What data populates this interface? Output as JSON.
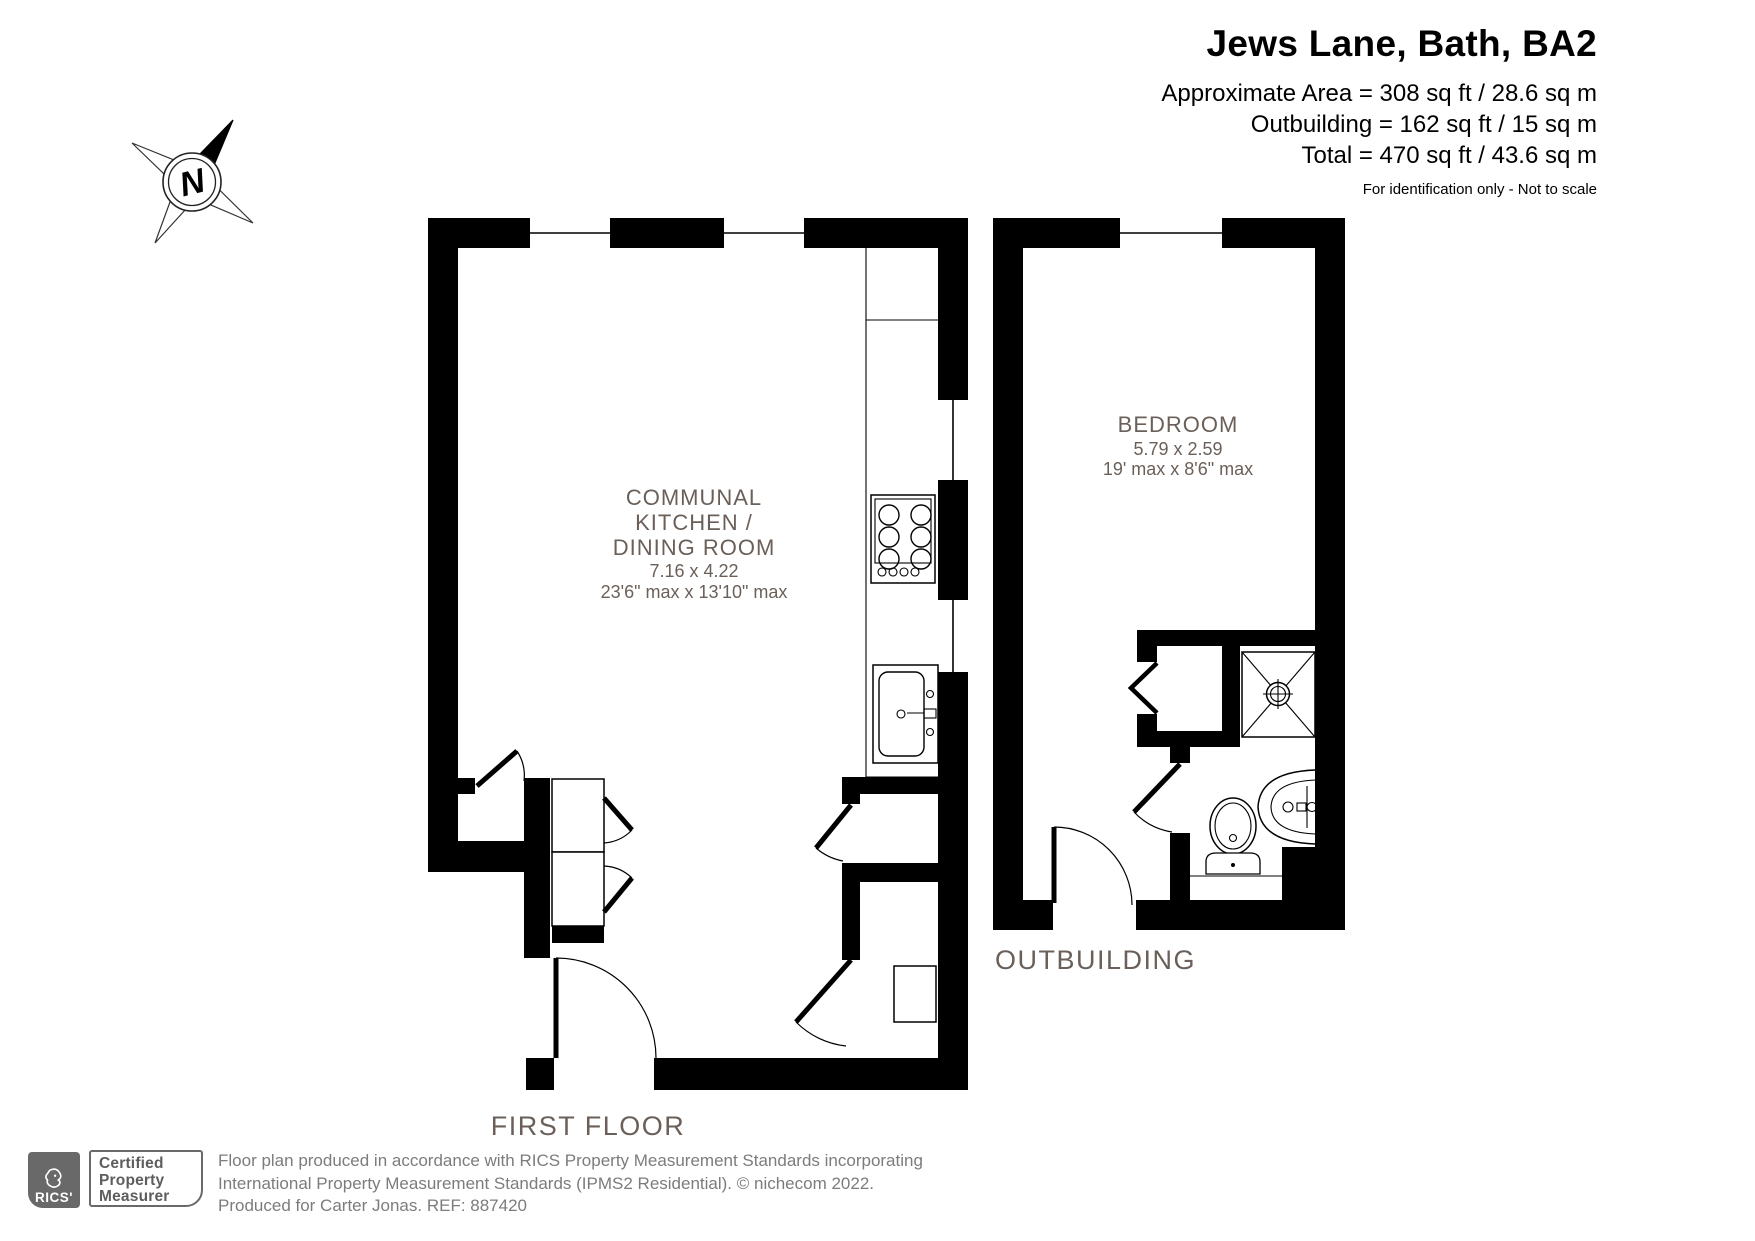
{
  "header": {
    "title": "Jews Lane, Bath, BA2",
    "area_line1": "Approximate Area = 308 sq ft / 28.6 sq m",
    "area_line2": "Outbuilding = 162 sq ft / 15 sq m",
    "area_line3": "Total = 470 sq ft / 43.6 sq m",
    "disclaimer": "For identification only - Not to scale"
  },
  "compass": {
    "north_label": "N"
  },
  "rooms": {
    "kitchen": {
      "line1": "COMMUNAL",
      "line2": "KITCHEN /",
      "line3": "DINING ROOM",
      "dims_metric": "7.16 x 4.22",
      "dims_imperial": "23'6\" max x 13'10\" max"
    },
    "bedroom": {
      "name": "BEDROOM",
      "dims_metric": "5.79 x 2.59",
      "dims_imperial": "19' max x 8'6\" max"
    }
  },
  "floor_labels": {
    "first_floor": "FIRST FLOOR",
    "outbuilding": "OUTBUILDING"
  },
  "footer": {
    "rics_wordmark": "RICS'",
    "badge": {
      "line1": "Certified",
      "line2": "Property",
      "line3": "Measurer"
    },
    "line1": "Floor plan produced in accordance with RICS Property Measurement Standards incorporating",
    "line2": "International Property Measurement Standards (IPMS2 Residential).   © nichecom 2022.",
    "line3": "Produced for Carter Jonas.   REF:  887420"
  },
  "colors": {
    "wall": "#000000",
    "room_label": "#6b6059",
    "floor_label": "#6b6059",
    "footer_text": "#7c7c7c",
    "rics_gray": "#696969"
  }
}
